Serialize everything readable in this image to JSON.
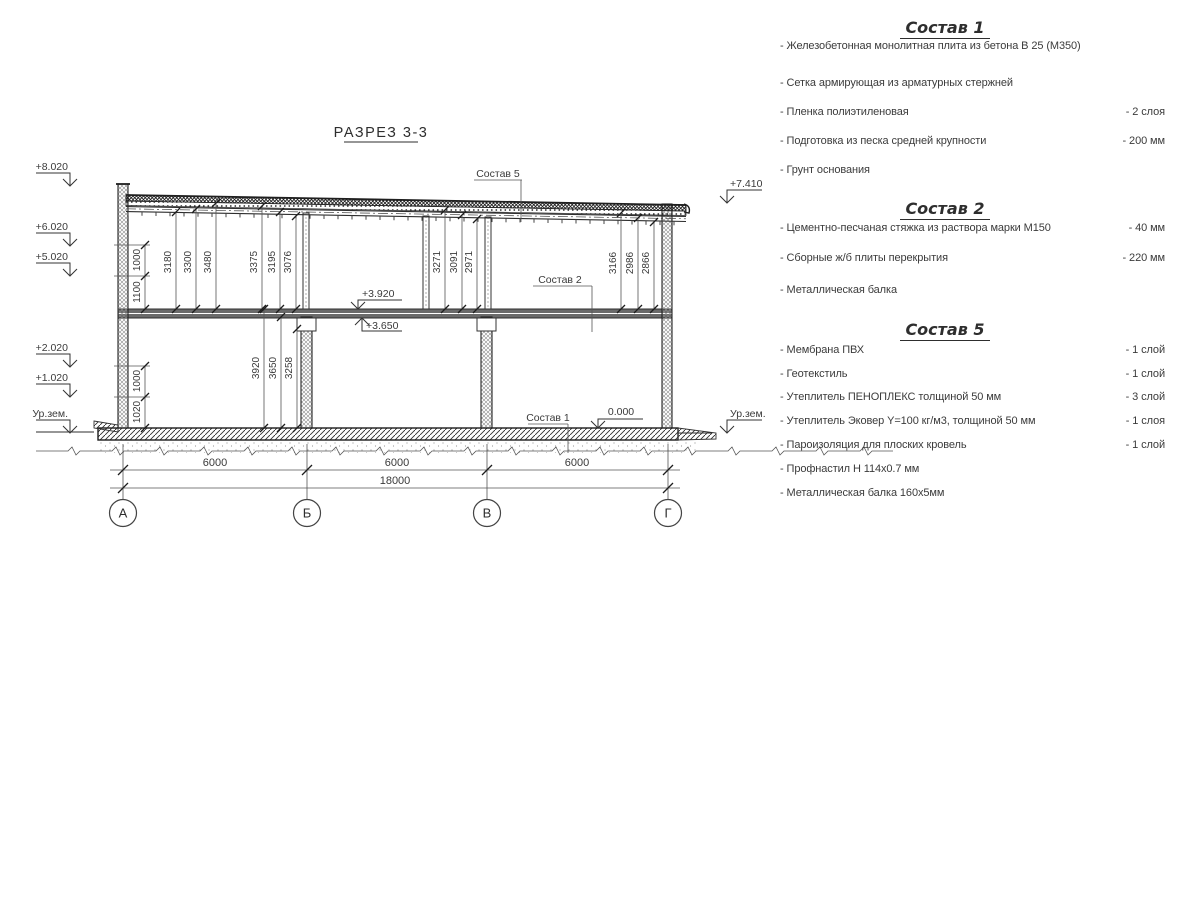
{
  "colors": {
    "background": "#ffffff",
    "line": "#2e2e2e",
    "text": "#3a3a3a"
  },
  "section": {
    "title": "РАЗРЕЗ 3-3",
    "axes": [
      "А",
      "Б",
      "В",
      "Г"
    ],
    "span_dims": [
      "6000",
      "6000",
      "6000"
    ],
    "total_dim": "18000",
    "elevations": {
      "left": [
        "+8.020",
        "+6.020",
        "+5.020",
        "+2.020",
        "+1.020",
        "Ур.зем."
      ],
      "right": [
        "+7.410",
        "Ур.зем."
      ],
      "floor": [
        "+3.920",
        "+3.650",
        "0.000"
      ]
    },
    "leaders": [
      "Состав 5",
      "Состав 2",
      "Состав 1"
    ],
    "dims_upper": [
      "3180",
      "3300",
      "3480",
      "3375",
      "3195",
      "3076",
      "3271",
      "3091",
      "2971",
      "3166",
      "2986",
      "2866"
    ],
    "dims_lower": [
      "3920",
      "3650",
      "3258"
    ],
    "chain_dims": [
      "1000",
      "1100",
      "1000",
      "1020"
    ]
  },
  "lists": [
    {
      "title": "Состав 1",
      "items": [
        {
          "label": "- Железобетонная  монолитная плита из бетона В 25 (М350)",
          "qty": ""
        },
        {
          "label": "- Сетка армирующая из арматурных стержней",
          "qty": ""
        },
        {
          "label": "- Пленка полиэтиленовая",
          "qty": "-  2 слоя"
        },
        {
          "label": "- Подготовка из песка средней крупности",
          "qty": "- 200 мм"
        },
        {
          "label": "- Грунт основания",
          "qty": ""
        }
      ]
    },
    {
      "title": "Состав 2",
      "items": [
        {
          "label": "- Цементно-песчаная стяжка из раствора марки М150",
          "qty": "- 40 мм"
        },
        {
          "label": "- Сборные ж/б плиты перекрытия",
          "qty": "- 220 мм"
        },
        {
          "label": "- Металлическая балка",
          "qty": ""
        }
      ]
    },
    {
      "title": "Состав 5",
      "items": [
        {
          "label": "- Мембрана ПВХ",
          "qty": "- 1 слой"
        },
        {
          "label": "- Геотекстиль",
          "qty": "- 1 слой"
        },
        {
          "label": "- Утеплитель ПЕНОПЛЕКС толщиной 50 мм",
          "qty": "- 3 слой"
        },
        {
          "label": "- Утеплитель Эковер Y=100 кг/м3, толщиной 50 мм",
          "qty": "- 1 слоя"
        },
        {
          "label": "- Пароизоляция для плоских кровель",
          "qty": "- 1 слой"
        },
        {
          "label": "- Профнастил Н 114х0.7 мм",
          "qty": ""
        },
        {
          "label": "- Металлическая балка 160х5мм",
          "qty": ""
        }
      ]
    }
  ]
}
